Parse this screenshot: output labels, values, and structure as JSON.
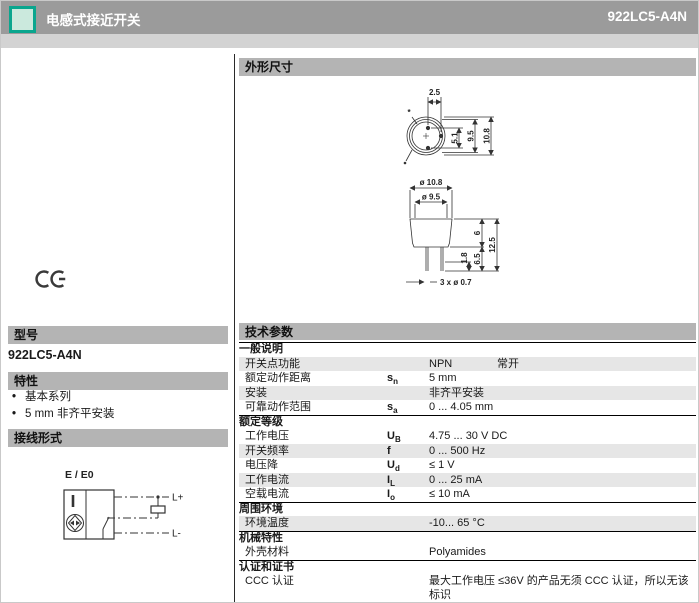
{
  "header": {
    "title": "电感式接近开关",
    "model": "922LC5-A4N"
  },
  "left": {
    "certification_mark": "CE",
    "model": {
      "title": "型号",
      "value": "922LC5-A4N"
    },
    "features": {
      "title": "特性",
      "items": [
        "基本系列",
        "5 mm 非齐平安装"
      ]
    },
    "wiring": {
      "title": "接线形式",
      "diagram_label": "E / E0",
      "terminal_plus": "L+",
      "terminal_minus": "L-"
    }
  },
  "dimensions": {
    "title": "外形尺寸",
    "top_view": {
      "pin_pitch": "2.5",
      "pin_span": "5.1",
      "inner_diameter": "9.5",
      "outer_diameter": "10.8"
    },
    "side_view": {
      "outer_diameter": "ø 10.8",
      "face_diameter": "ø 9.5",
      "body_height": "6",
      "total_height": "12.5",
      "pin_length": "6.5",
      "pin_offset": "1.8",
      "pin_note": "3 x ø 0.7"
    }
  },
  "specs": {
    "title": "技术参数",
    "rows": [
      {
        "type": "section",
        "label": "一般说明"
      },
      {
        "type": "row",
        "label": "开关点功能",
        "symbol": "",
        "value": "NPN",
        "value2": "常开",
        "shaded": true
      },
      {
        "type": "row",
        "label": "额定动作距离",
        "symbol": "s_n",
        "value": "5 mm",
        "shaded": false
      },
      {
        "type": "row",
        "label": "安装",
        "symbol": "",
        "value": "非齐平安装",
        "shaded": true
      },
      {
        "type": "row",
        "label": "可靠动作范围",
        "symbol": "s_a",
        "value": "0 ... 4.05 mm",
        "shaded": false
      },
      {
        "type": "section",
        "label": "额定等级"
      },
      {
        "type": "row",
        "label": "工作电压",
        "symbol": "U_B",
        "value": "4.75 ... 30 V DC",
        "shaded": false
      },
      {
        "type": "row",
        "label": "开关频率",
        "symbol": "f",
        "value": "0 ... 500 Hz",
        "shaded": true
      },
      {
        "type": "row",
        "label": "电压降",
        "symbol": "U_d",
        "value": "≤ 1 V",
        "shaded": false
      },
      {
        "type": "row",
        "label": "工作电流",
        "symbol": "I_L",
        "value": "0 ... 25 mA",
        "shaded": true
      },
      {
        "type": "row",
        "label": "空载电流",
        "symbol": "I_o",
        "value": "≤ 10 mA",
        "shaded": false
      },
      {
        "type": "section",
        "label": "周围环境"
      },
      {
        "type": "row",
        "label": "环境温度",
        "symbol": "",
        "value": "-10... 65 °C",
        "shaded": true
      },
      {
        "type": "section",
        "label": "机械特性"
      },
      {
        "type": "row",
        "label": "外壳材料",
        "symbol": "",
        "value": "Polyamides",
        "shaded": false
      },
      {
        "type": "section",
        "label": "认证和证书"
      },
      {
        "type": "row",
        "label": "CCC 认证",
        "symbol": "",
        "value": "最大工作电压 ≤36V 的产品无须 CCC 认证，所以无该标识",
        "shaded": false,
        "tall": true
      }
    ]
  },
  "colors": {
    "header_bar": "#9b9b9b",
    "sub_strip": "#d3d3d3",
    "section_bar": "#b4b4b4",
    "row_shade": "#e6e6e6",
    "accent_teal": "#0aa68e",
    "icon_fill": "#cbe9dd"
  }
}
